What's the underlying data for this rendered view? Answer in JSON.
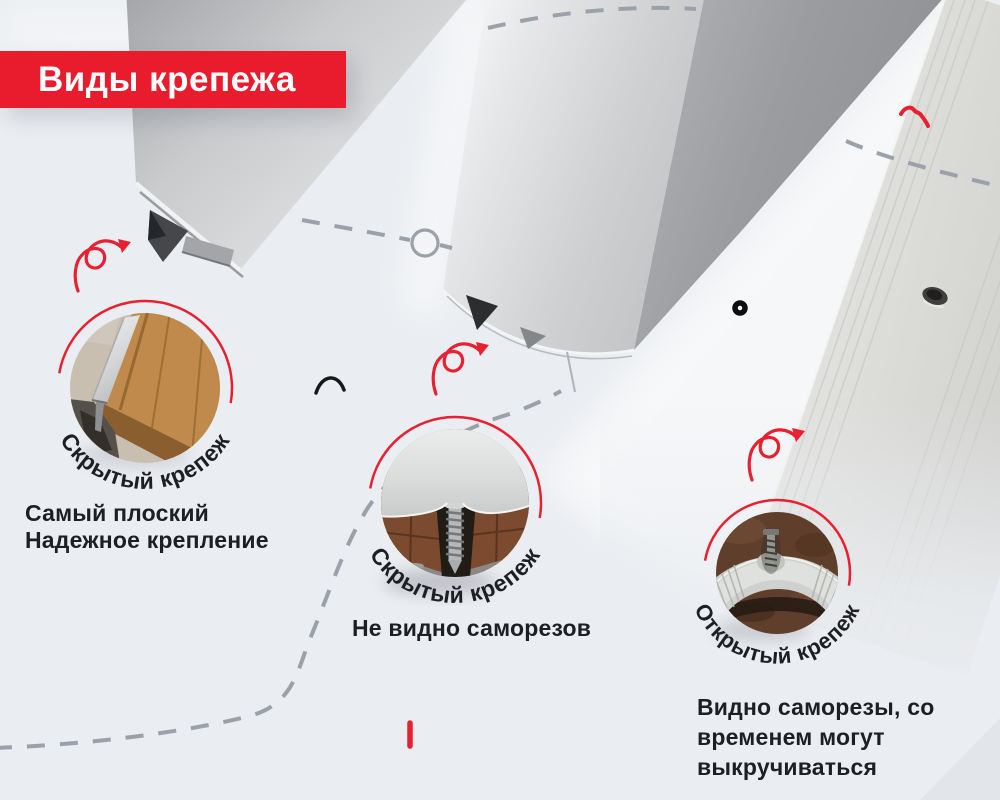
{
  "banner": {
    "label": "Виды крепежа"
  },
  "colors": {
    "banner_red": "#e81c2c",
    "accent_red": "#e8202f",
    "dash_gray": "#9ba1a9",
    "background": "#eaedf1",
    "text_dark": "#1e1f23"
  },
  "fastener_types": [
    {
      "id": "t-molding-hidden",
      "badge": "Скрытый крепеж",
      "caption_lines": [
        "Самый плоский",
        "Надежное крепление"
      ]
    },
    {
      "id": "dome-hidden",
      "badge": "Скрытый крепеж",
      "caption_lines": [
        "Не видно саморезов"
      ]
    },
    {
      "id": "flat-exposed",
      "badge": "Открытый крепеж",
      "caption_lines": [
        "Видно саморезы, со",
        "временем могут",
        "выкручиваться"
      ]
    }
  ]
}
